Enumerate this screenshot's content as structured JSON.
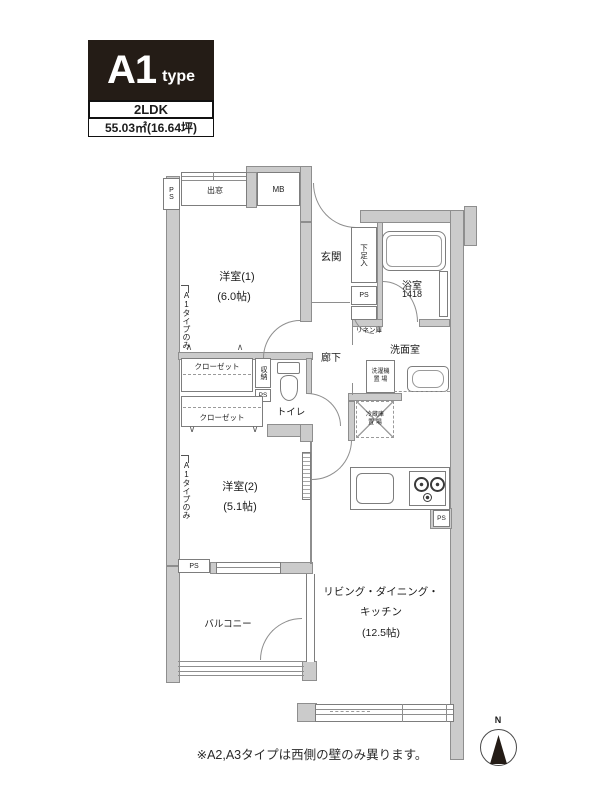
{
  "title_block": {
    "type_code": "A1",
    "type_word": "type",
    "layout": "2LDK",
    "area": "55.03㎡(16.64坪)"
  },
  "rooms": {
    "western1": {
      "name": "洋室(1)",
      "size": "(6.0帖)"
    },
    "western2": {
      "name": "洋室(2)",
      "size": "(5.1帖)"
    },
    "ldk": {
      "name_line1": "リビング・ダイニング・",
      "name_line2": "キッチン",
      "size": "(12.5帖)"
    },
    "entrance": "玄関",
    "hallway": "廊下",
    "toilet": "トイレ",
    "bath": {
      "name": "浴室",
      "size": "1418"
    },
    "washroom": "洗面室",
    "balcony": "バルコニー"
  },
  "features": {
    "bay_window": "出窓",
    "meter_box": "MB",
    "pipe_space": "PS",
    "shoe_box": "下足入",
    "linen": "リネン庫",
    "closet": "クローゼット",
    "storage": "収納",
    "washer_l1": "洗濯機",
    "washer_l2": "置 場",
    "fridge_l1": "冷蔵庫",
    "fridge_l2": "置 場",
    "a1_only": "A1タイプのみ"
  },
  "compass": {
    "north": "N"
  },
  "note": "※A2,A3タイプは西側の壁のみ異ります。",
  "colors": {
    "wall": "#cbcbcb",
    "wall_edge": "#8e8e8e",
    "title_bg": "#241c16",
    "line": "#7d7d7d"
  }
}
